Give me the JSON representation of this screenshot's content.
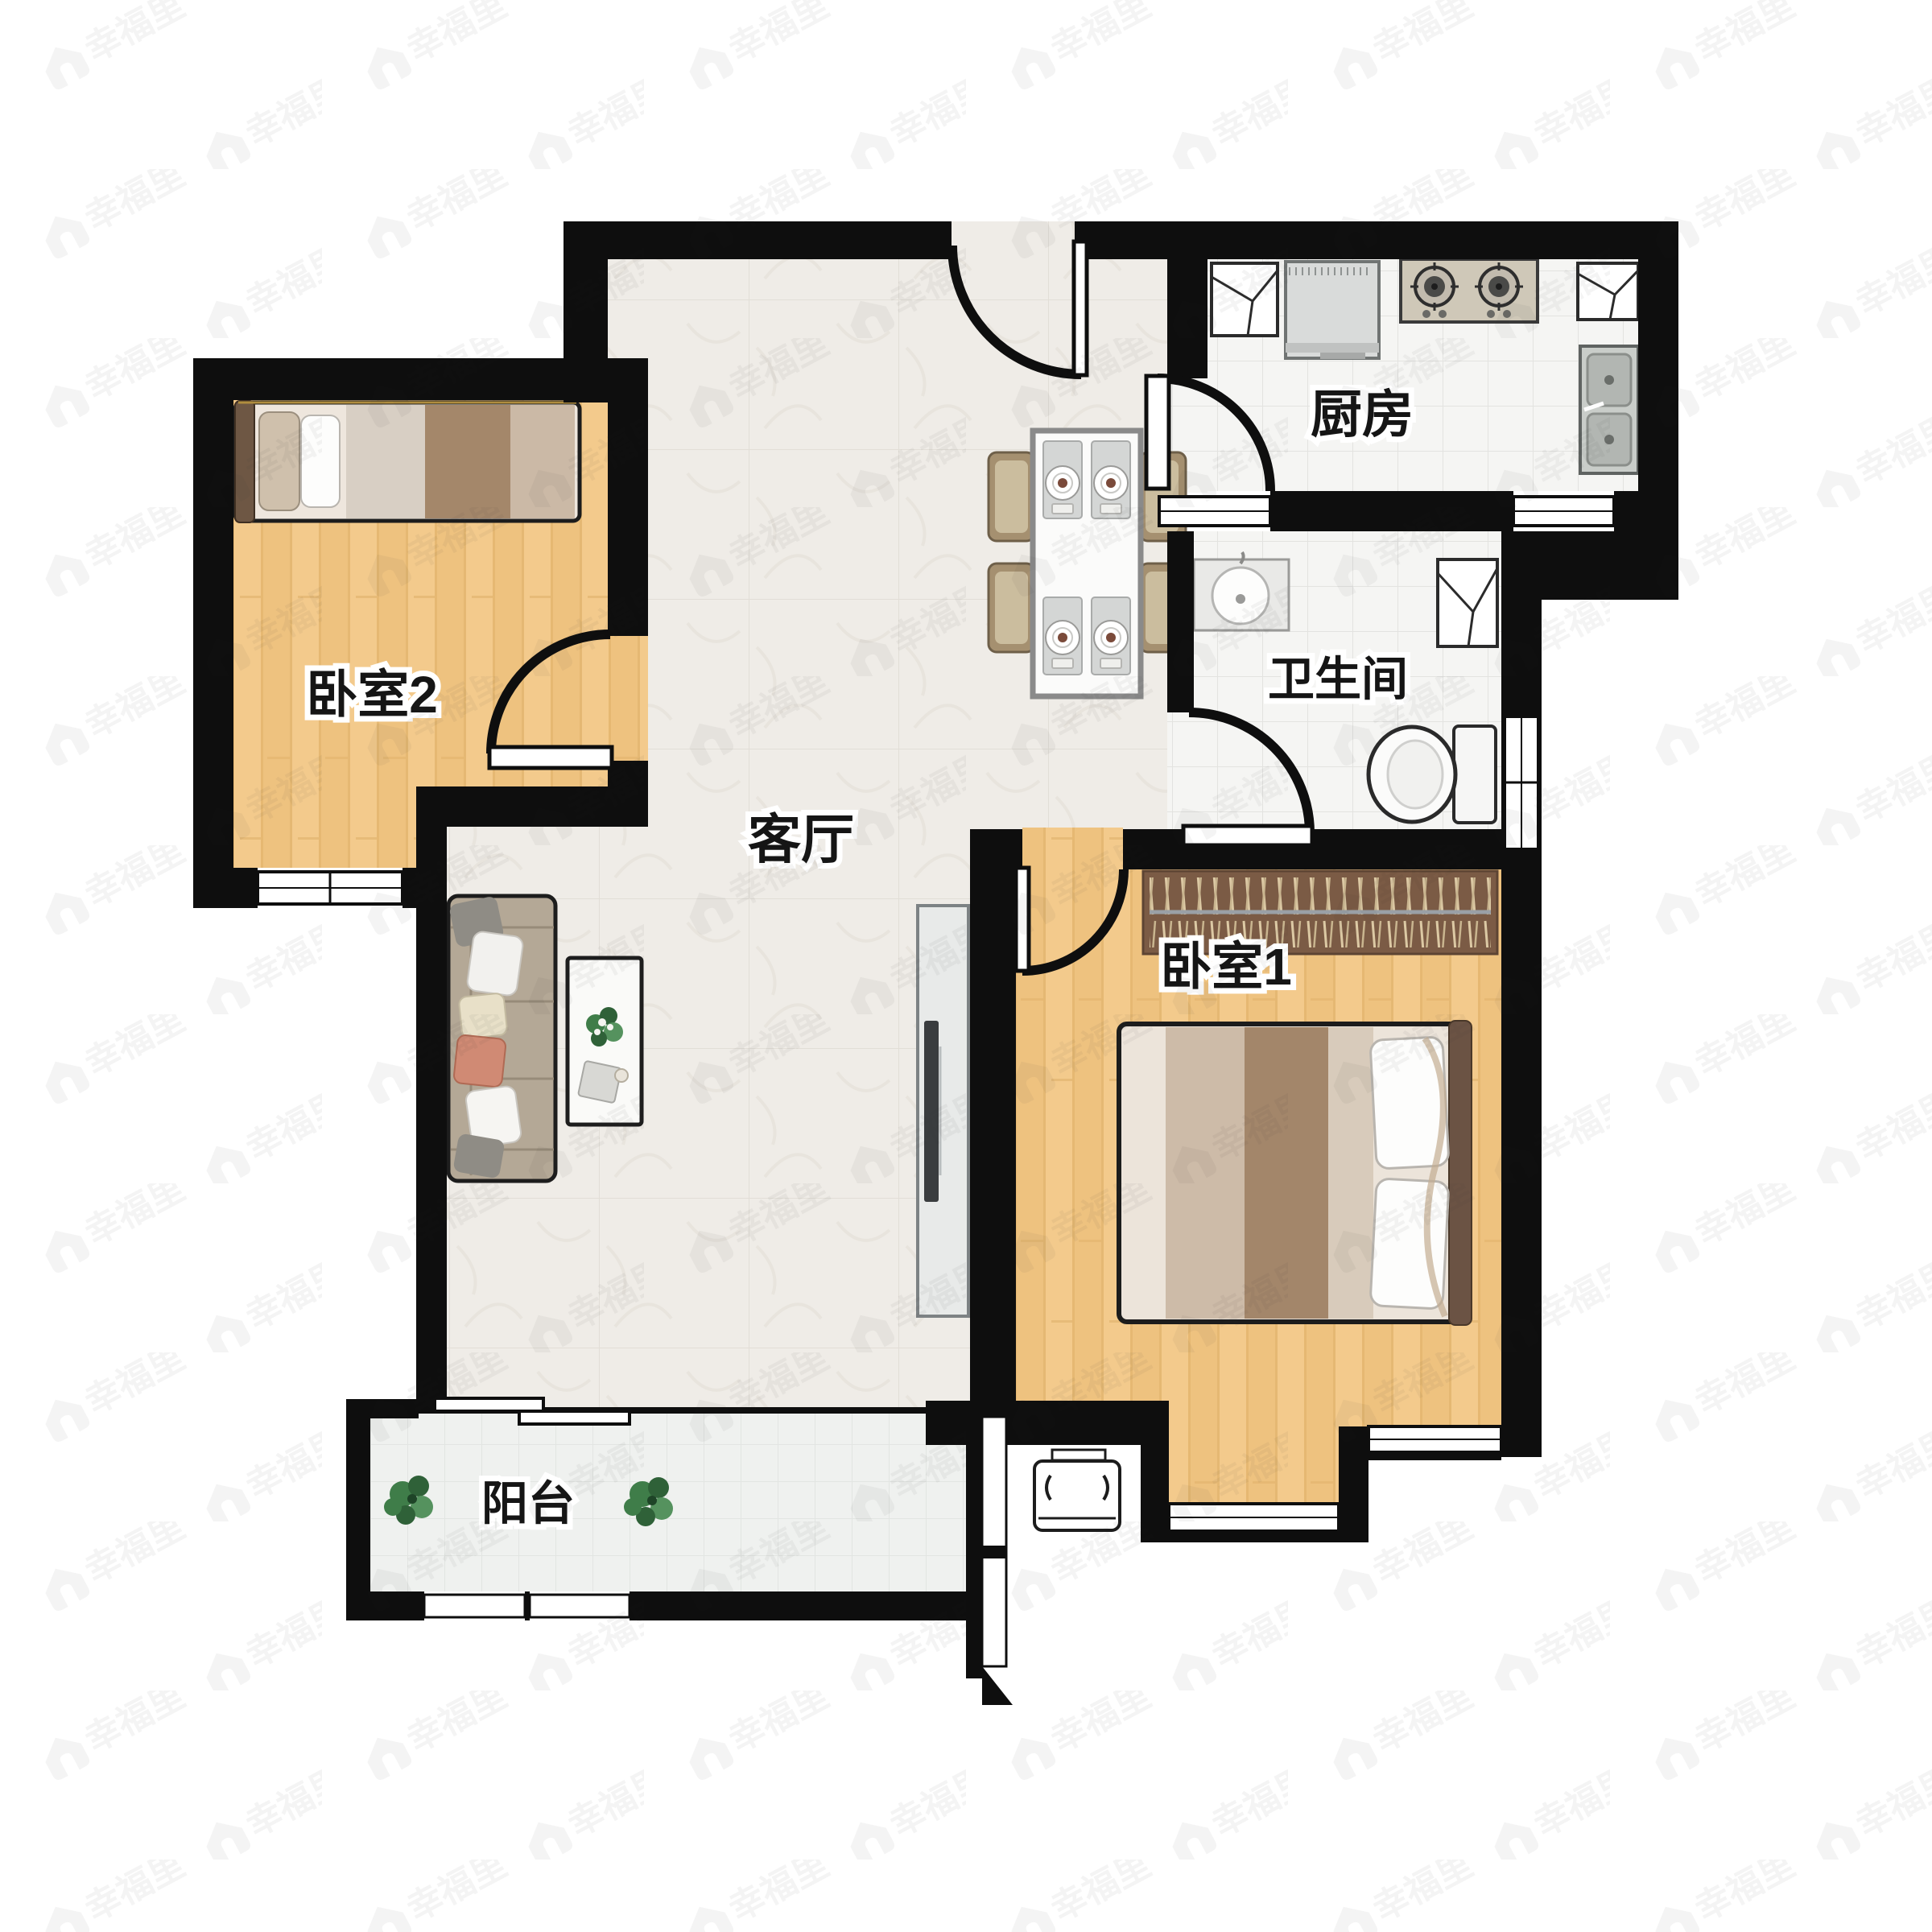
{
  "floorplan": {
    "title_visible": false,
    "watermark": "幸福里",
    "rooms": [
      {
        "id": "bedroom2",
        "label": "卧室2"
      },
      {
        "id": "living-room",
        "label": "客厅"
      },
      {
        "id": "kitchen",
        "label": "厨房"
      },
      {
        "id": "bathroom",
        "label": "卫生间"
      },
      {
        "id": "bedroom1",
        "label": "卧室1"
      },
      {
        "id": "balcony",
        "label": "阳台"
      }
    ],
    "icons": [
      "single-bed-icon",
      "double-bed-icon",
      "wardrobe-icon",
      "sofa-icon",
      "coffee-table-icon",
      "tv-stand-icon",
      "dining-table-icon",
      "chair-icon",
      "gas-stove-icon",
      "kitchen-sink-icon",
      "fridge-icon",
      "corner-cabinet-icon",
      "bath-sink-icon",
      "toilet-icon",
      "plant-icon",
      "air-conditioner-icon",
      "door-swing-icon",
      "sliding-door-icon",
      "window-icon",
      "watermark-house-icon"
    ],
    "colors": {
      "wall": "#0e0e0e",
      "wood_floor": "#f3ca8c",
      "marble_floor": "#efece7",
      "tile_floor": "#f5f5f3",
      "balcony_floor": "#eff1ef",
      "wardrobe": "#7b5b45",
      "sofa": "#b4a896",
      "accent_pillow": "#d08a74",
      "plant": "#3f7d49",
      "stove": "#cfc8b8"
    }
  }
}
